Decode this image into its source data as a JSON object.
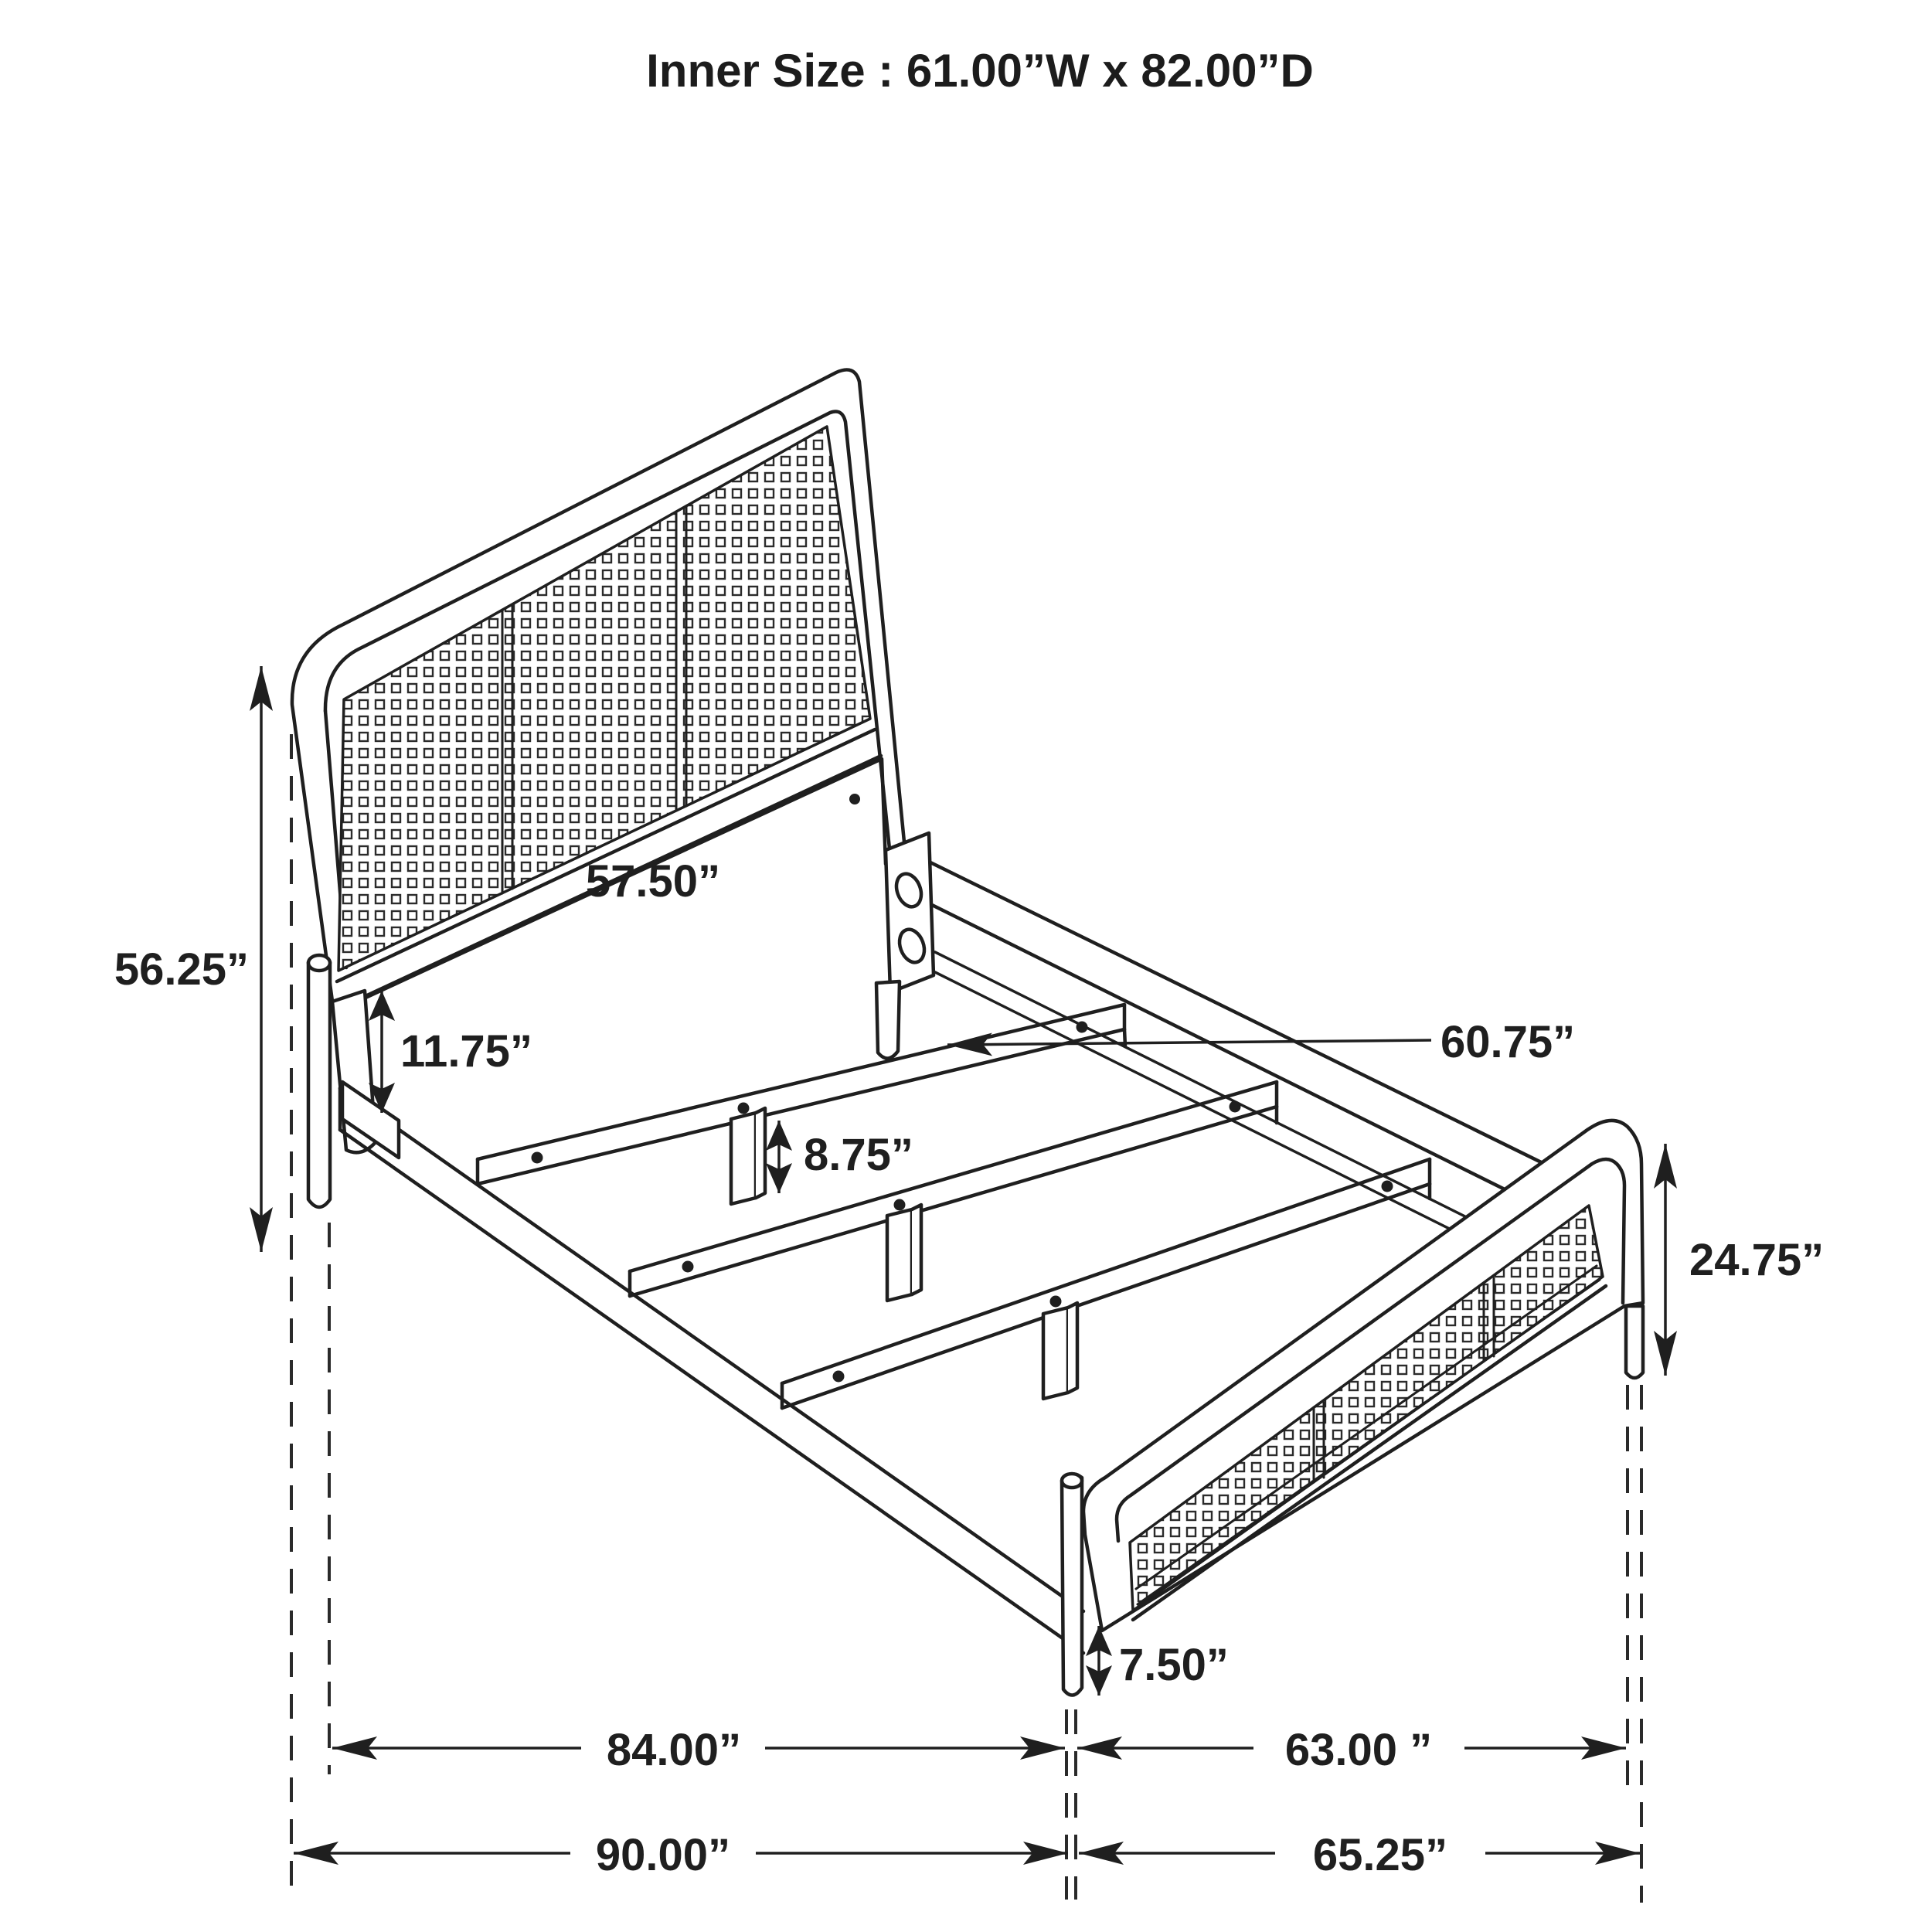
{
  "title": "Inner Size : 61.00”W x 82.00”D",
  "drawing": {
    "subject": "bed frame isometric dimension drawing with cane headboard and footboard",
    "units": "inches",
    "line_color": "#1f1f1f",
    "background": "#ffffff",
    "inner_size": {
      "width_label": "61.00”W",
      "depth_label": "82.00”D",
      "width_in": 61.0,
      "depth_in": 82.0
    }
  },
  "dimensions": {
    "headboard_height": {
      "label": "56.25”",
      "value_in": 56.25,
      "orientation": "vertical"
    },
    "headboard_width": {
      "label": "57.50”",
      "value_in": 57.5,
      "orientation": "horizontal"
    },
    "panel_to_rail_gap": {
      "label": "11.75”",
      "value_in": 11.75,
      "orientation": "vertical"
    },
    "slat_length": {
      "label": "60.75”",
      "value_in": 60.75,
      "orientation": "leader"
    },
    "center_leg_height": {
      "label": "8.75”",
      "value_in": 8.75,
      "orientation": "vertical"
    },
    "footboard_height": {
      "label": "24.75”",
      "value_in": 24.75,
      "orientation": "vertical"
    },
    "footboard_leg_height": {
      "label": "7.50”",
      "value_in": 7.5,
      "orientation": "vertical"
    },
    "rail_length": {
      "label": "84.00”",
      "value_in": 84.0,
      "orientation": "horizontal"
    },
    "footboard_width": {
      "label": "63.00 ”",
      "value_in": 63.0,
      "orientation": "horizontal"
    },
    "overall_length": {
      "label": "90.00”",
      "value_in": 90.0,
      "orientation": "horizontal"
    },
    "overall_width": {
      "label": "65.25”",
      "value_in": 65.25,
      "orientation": "horizontal"
    }
  }
}
